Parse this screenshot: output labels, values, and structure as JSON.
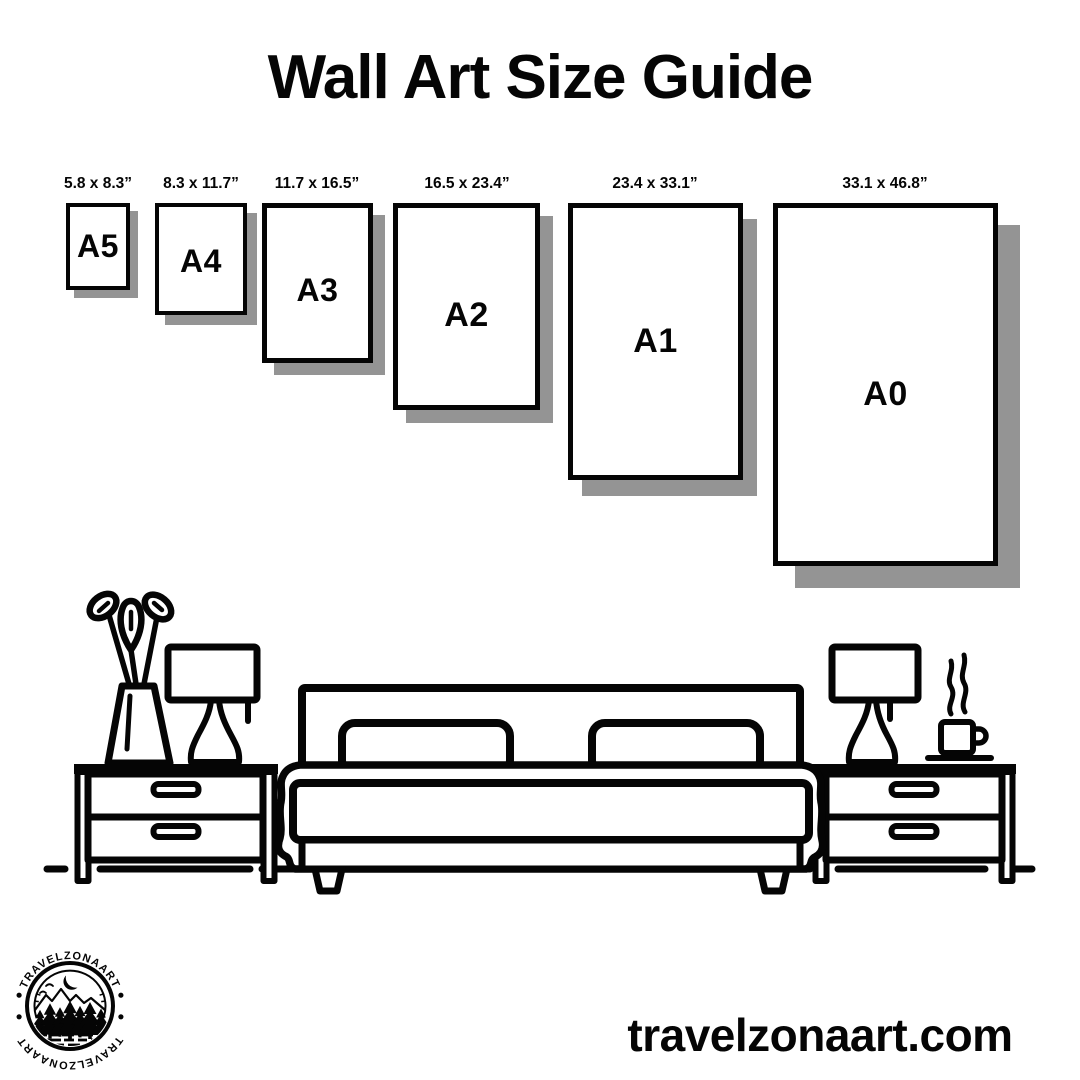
{
  "title": "Wall Art Size Guide",
  "sizes": [
    {
      "code": "A5",
      "dimensions": "5.8 x 8.3”"
    },
    {
      "code": "A4",
      "dimensions": "8.3 x 11.7”"
    },
    {
      "code": "A3",
      "dimensions": "11.7 x 16.5”"
    },
    {
      "code": "A2",
      "dimensions": "16.5 x 23.4”"
    },
    {
      "code": "A1",
      "dimensions": "23.4 x 33.1”"
    },
    {
      "code": "A0",
      "dimensions": "33.1 x 46.8”"
    }
  ],
  "logo": {
    "brand_top": "TRAVELZONAART",
    "brand_bottom": "TRAVELZONAART",
    "separator": "•"
  },
  "footer": {
    "website": "travelzonaart.com"
  },
  "scene": {
    "description": "line-art bedroom with double bed, two nightstands, two lamps, vase with plant, steaming coffee cup"
  },
  "colors": {
    "ink": "#050505",
    "shadow": "#949494",
    "background": "#ffffff"
  }
}
